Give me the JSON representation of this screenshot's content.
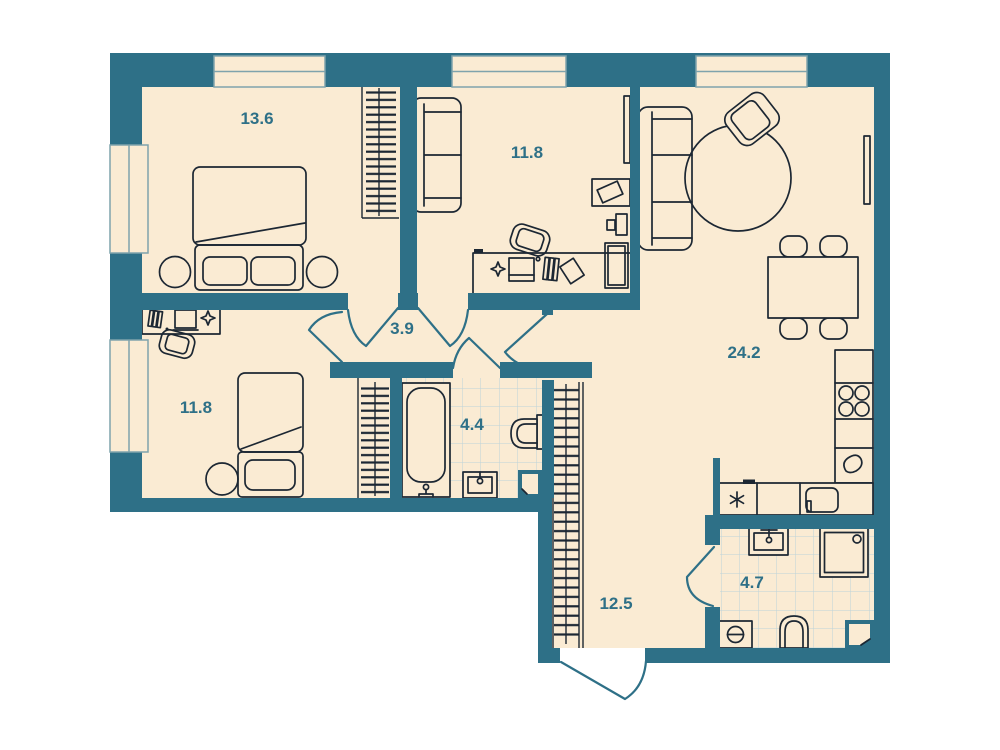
{
  "plan": {
    "title": "apartment-floor-plan",
    "rooms": [
      {
        "name": "bedroom-large",
        "area": "13.6"
      },
      {
        "name": "study",
        "area": "11.8"
      },
      {
        "name": "living-kitchen",
        "area": "24.2"
      },
      {
        "name": "hallway",
        "area": "3.9"
      },
      {
        "name": "bedroom-small",
        "area": "11.8"
      },
      {
        "name": "bathroom",
        "area": "4.4"
      },
      {
        "name": "corridor",
        "area": "12.5"
      },
      {
        "name": "shower-room",
        "area": "4.7"
      }
    ],
    "colors": {
      "wall": "#2E7087",
      "floor": "#FAEBD3",
      "furniture_line": "#1C2733",
      "tile_line": "#BCD3D9",
      "window_line": "#7FA3AC",
      "label": "#2E7087",
      "background": "#FFFFFF"
    }
  }
}
